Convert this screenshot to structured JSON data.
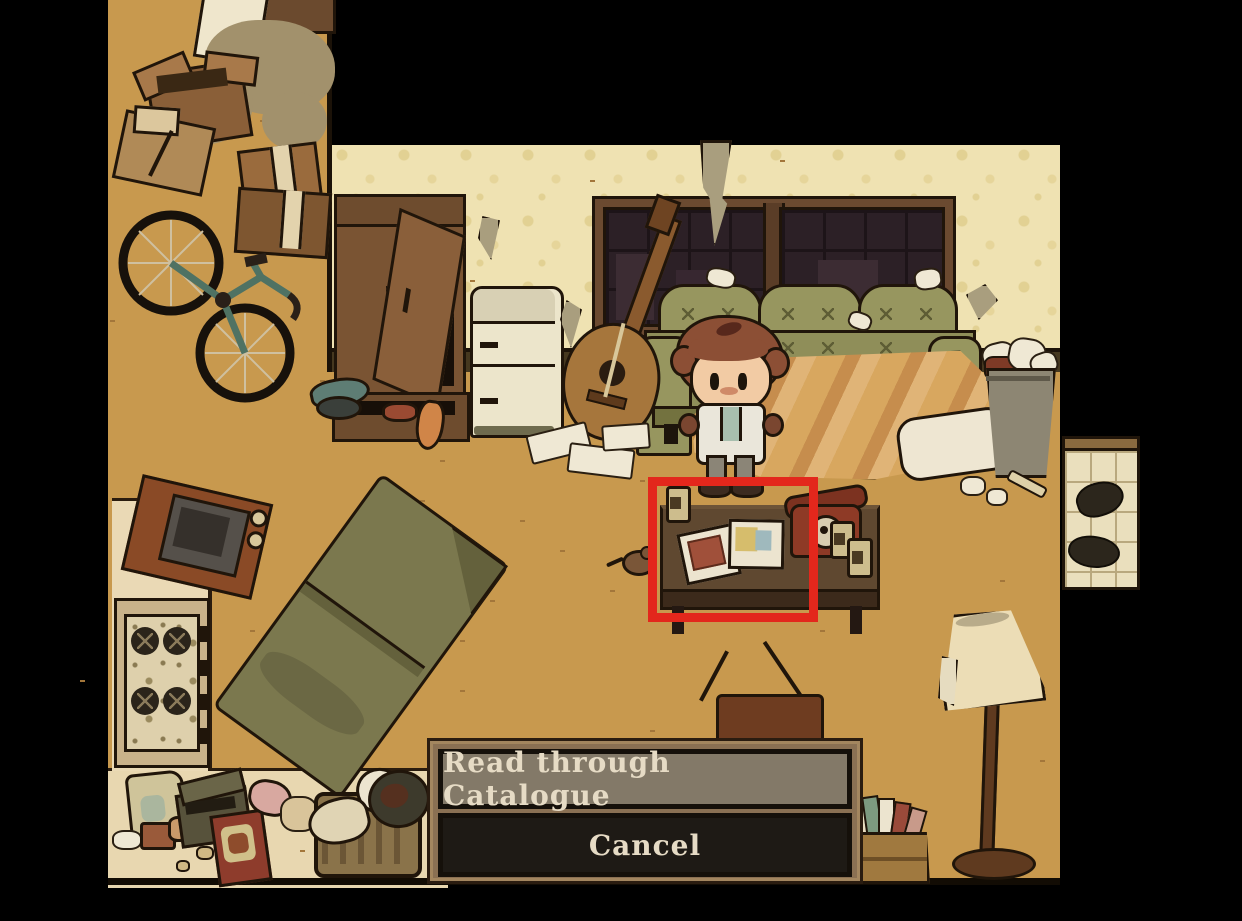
{
  "scene": {
    "name": "messy-apartment-room",
    "objects": [
      "cardboard-boxes",
      "bicycle",
      "wardrobe",
      "refrigerator",
      "guitar",
      "window",
      "couch",
      "blanket",
      "pillow",
      "trash-can",
      "player-character",
      "coffee-table",
      "catalogue",
      "rotary-phone",
      "beer-cans",
      "mouse",
      "sleeping-bag",
      "microwave",
      "stove",
      "kitchen-trash",
      "tv-with-antenna",
      "records-crate",
      "floor-lamp",
      "entry-mat",
      "shoes"
    ]
  },
  "highlight_box": {
    "target": "catalogue-on-coffee-table",
    "color": "#e3271c"
  },
  "dialog": {
    "options": [
      {
        "id": "read-catalogue",
        "label": "Read through Catalogue",
        "highlighted": true
      },
      {
        "id": "cancel",
        "label": "Cancel",
        "highlighted": false
      }
    ]
  },
  "palette": {
    "floor": "#c8994e",
    "kitchen_floor": "#e8d7b0",
    "wallpaper": "#efe2b2",
    "baseboard": "#46381f",
    "outline": "#20150a",
    "couch": "#8f8e59",
    "blanket": "#d8a75f",
    "table": "#5f4830",
    "phone": "#8e3a26",
    "dialog_frame": "#8a7053",
    "dialog_option_bg": "#837968",
    "dialog_cancel_bg": "#1e1a15",
    "dialog_text": "#e6dbc5",
    "character_hair": "#8c4f35",
    "character_skin": "#f2cba4",
    "sleeping_bag": "#7b784e",
    "lamp_shade": "#ecddb6"
  }
}
